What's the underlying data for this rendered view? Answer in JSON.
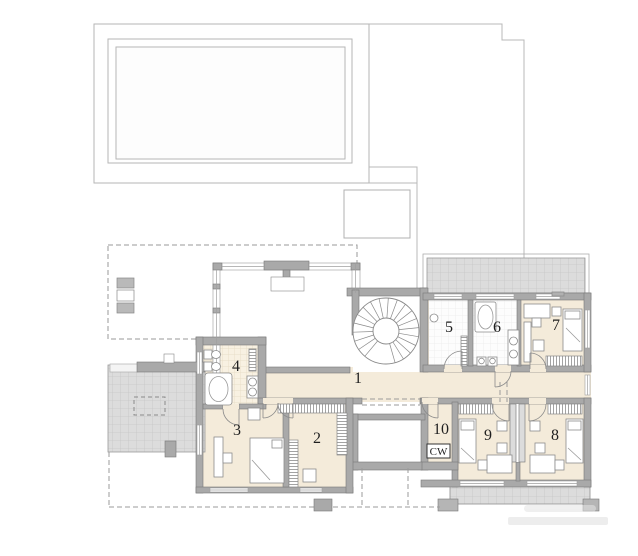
{
  "plan": {
    "room_labels": [
      "1",
      "2",
      "3",
      "4",
      "5",
      "6",
      "7",
      "8",
      "9",
      "10"
    ],
    "utility_label": "CW",
    "colors": {
      "floor_beige": "#f4ebda",
      "wall_gray": "#a9a9a9",
      "paving_gray": "#dcdcdc",
      "tile_white": "#fdfdfd",
      "tile_beige": "#f8f1e2",
      "line_gray": "#8a8a8a",
      "boundary_gray": "#b8b8b8"
    }
  }
}
